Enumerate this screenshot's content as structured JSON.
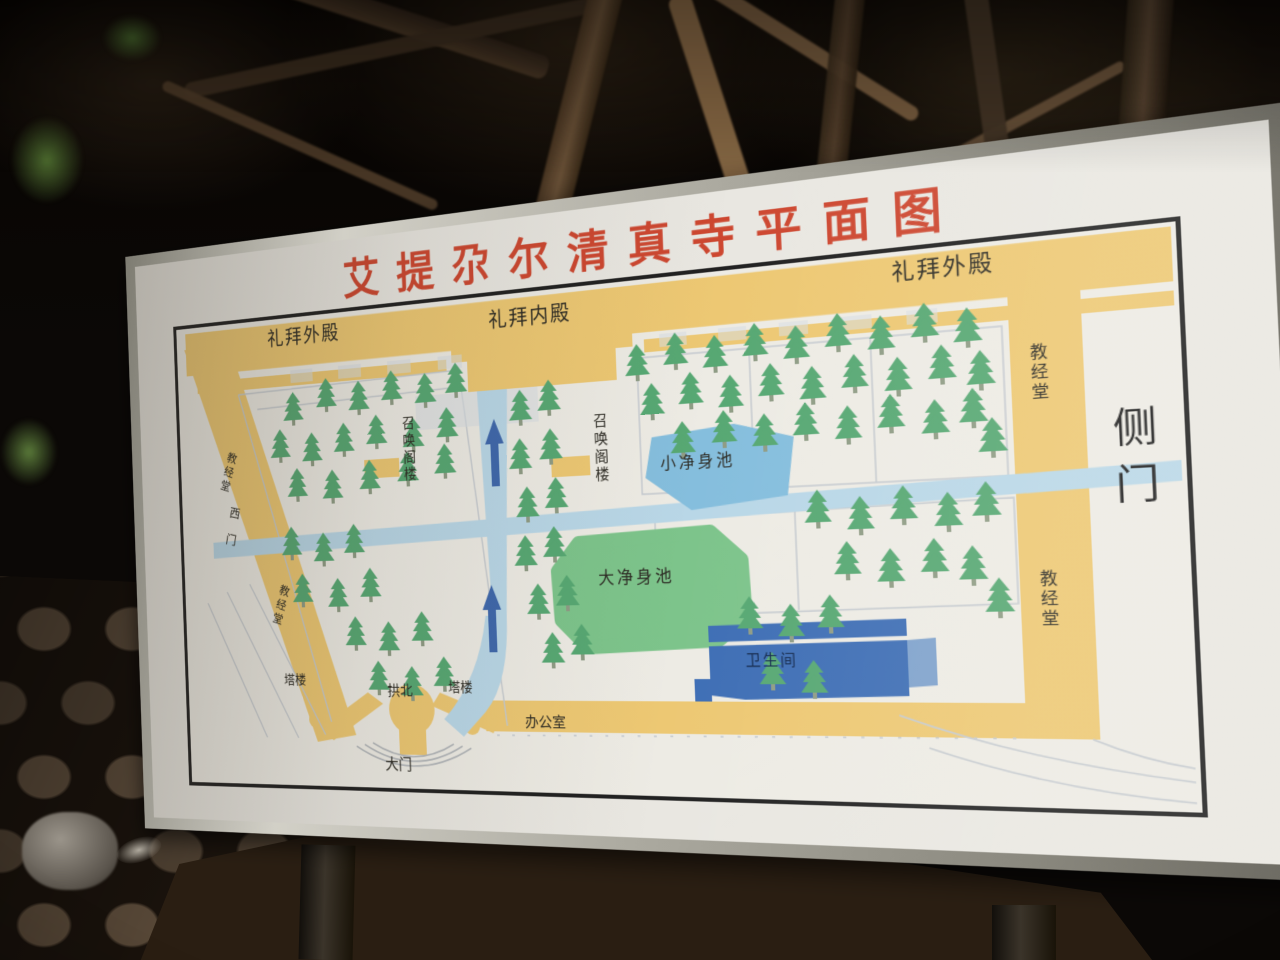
{
  "sign": {
    "title": "艾提尕尔清真寺平面图",
    "map": {
      "labels": {
        "outer_hall_left": "礼拜外殿",
        "inner_hall": "礼拜内殿",
        "outer_hall_right": "礼拜外殿",
        "scripture_hall_left_top": "教经堂",
        "scripture_hall_left_bottom": "教经堂",
        "scripture_hall_right_top": "教经堂",
        "scripture_hall_right_bottom": "教经堂",
        "side_gate": "侧门",
        "west_gate": "西门",
        "minaret_left": "召唤阁楼",
        "minaret_right": "召唤阁楼",
        "small_ablution_pool": "小净身池",
        "large_ablution_pool": "大净身池",
        "restroom": "卫生间",
        "gongbei": "拱北",
        "tower_left": "塔楼",
        "tower_right": "塔楼",
        "office": "办公室",
        "main_gate": "大门"
      },
      "colors": {
        "title_red": "#cd4730",
        "hall_yellow": "#edc873",
        "walkway_blue": "#b9d7e7",
        "arrow_blue": "#3f68ac",
        "pond_blue": "#85bedd",
        "pool_green": "#7dc48b",
        "restroom_blue": "#3e6eb5",
        "tree_green": "#57a873",
        "outline_gray": "#c5cacf"
      },
      "trees": [
        [
          150,
          118
        ],
        [
          192,
          106
        ],
        [
          232,
          112
        ],
        [
          272,
          104
        ],
        [
          312,
          110
        ],
        [
          348,
          102
        ],
        [
          132,
          158
        ],
        [
          172,
          164
        ],
        [
          212,
          156
        ],
        [
          252,
          150
        ],
        [
          296,
          156
        ],
        [
          336,
          148
        ],
        [
          152,
          202
        ],
        [
          196,
          206
        ],
        [
          242,
          198
        ],
        [
          288,
          192
        ],
        [
          332,
          186
        ],
        [
          142,
          266
        ],
        [
          182,
          274
        ],
        [
          220,
          266
        ],
        [
          154,
          318
        ],
        [
          198,
          324
        ],
        [
          238,
          314
        ],
        [
          218,
          366
        ],
        [
          258,
          372
        ],
        [
          298,
          362
        ],
        [
          244,
          414
        ],
        [
          284,
          420
        ],
        [
          322,
          410
        ],
        [
          420,
          136
        ],
        [
          452,
          128
        ],
        [
          418,
          186
        ],
        [
          452,
          178
        ],
        [
          424,
          236
        ],
        [
          456,
          228
        ],
        [
          420,
          286
        ],
        [
          452,
          278
        ],
        [
          432,
          336
        ],
        [
          464,
          328
        ],
        [
          446,
          386
        ],
        [
          478,
          378
        ],
        [
          548,
          100
        ],
        [
          588,
          92
        ],
        [
          628,
          98
        ],
        [
          668,
          90
        ],
        [
          708,
          96
        ],
        [
          748,
          88
        ],
        [
          788,
          94
        ],
        [
          828,
          86
        ],
        [
          866,
          94
        ],
        [
          562,
          140
        ],
        [
          602,
          132
        ],
        [
          642,
          138
        ],
        [
          682,
          130
        ],
        [
          722,
          136
        ],
        [
          762,
          128
        ],
        [
          802,
          134
        ],
        [
          842,
          126
        ],
        [
          876,
          134
        ],
        [
          592,
          180
        ],
        [
          634,
          172
        ],
        [
          674,
          178
        ],
        [
          714,
          170
        ],
        [
          754,
          176
        ],
        [
          794,
          168
        ],
        [
          834,
          176
        ],
        [
          868,
          168
        ],
        [
          722,
          254
        ],
        [
          762,
          262
        ],
        [
          802,
          254
        ],
        [
          842,
          262
        ],
        [
          876,
          254
        ],
        [
          748,
          304
        ],
        [
          788,
          312
        ],
        [
          828,
          304
        ],
        [
          862,
          312
        ],
        [
          652,
          354
        ],
        [
          692,
          362
        ],
        [
          730,
          354
        ],
        [
          672,
          408
        ],
        [
          712,
          416
        ],
        [
          884,
          196
        ],
        [
          884,
          342
        ]
      ]
    }
  }
}
